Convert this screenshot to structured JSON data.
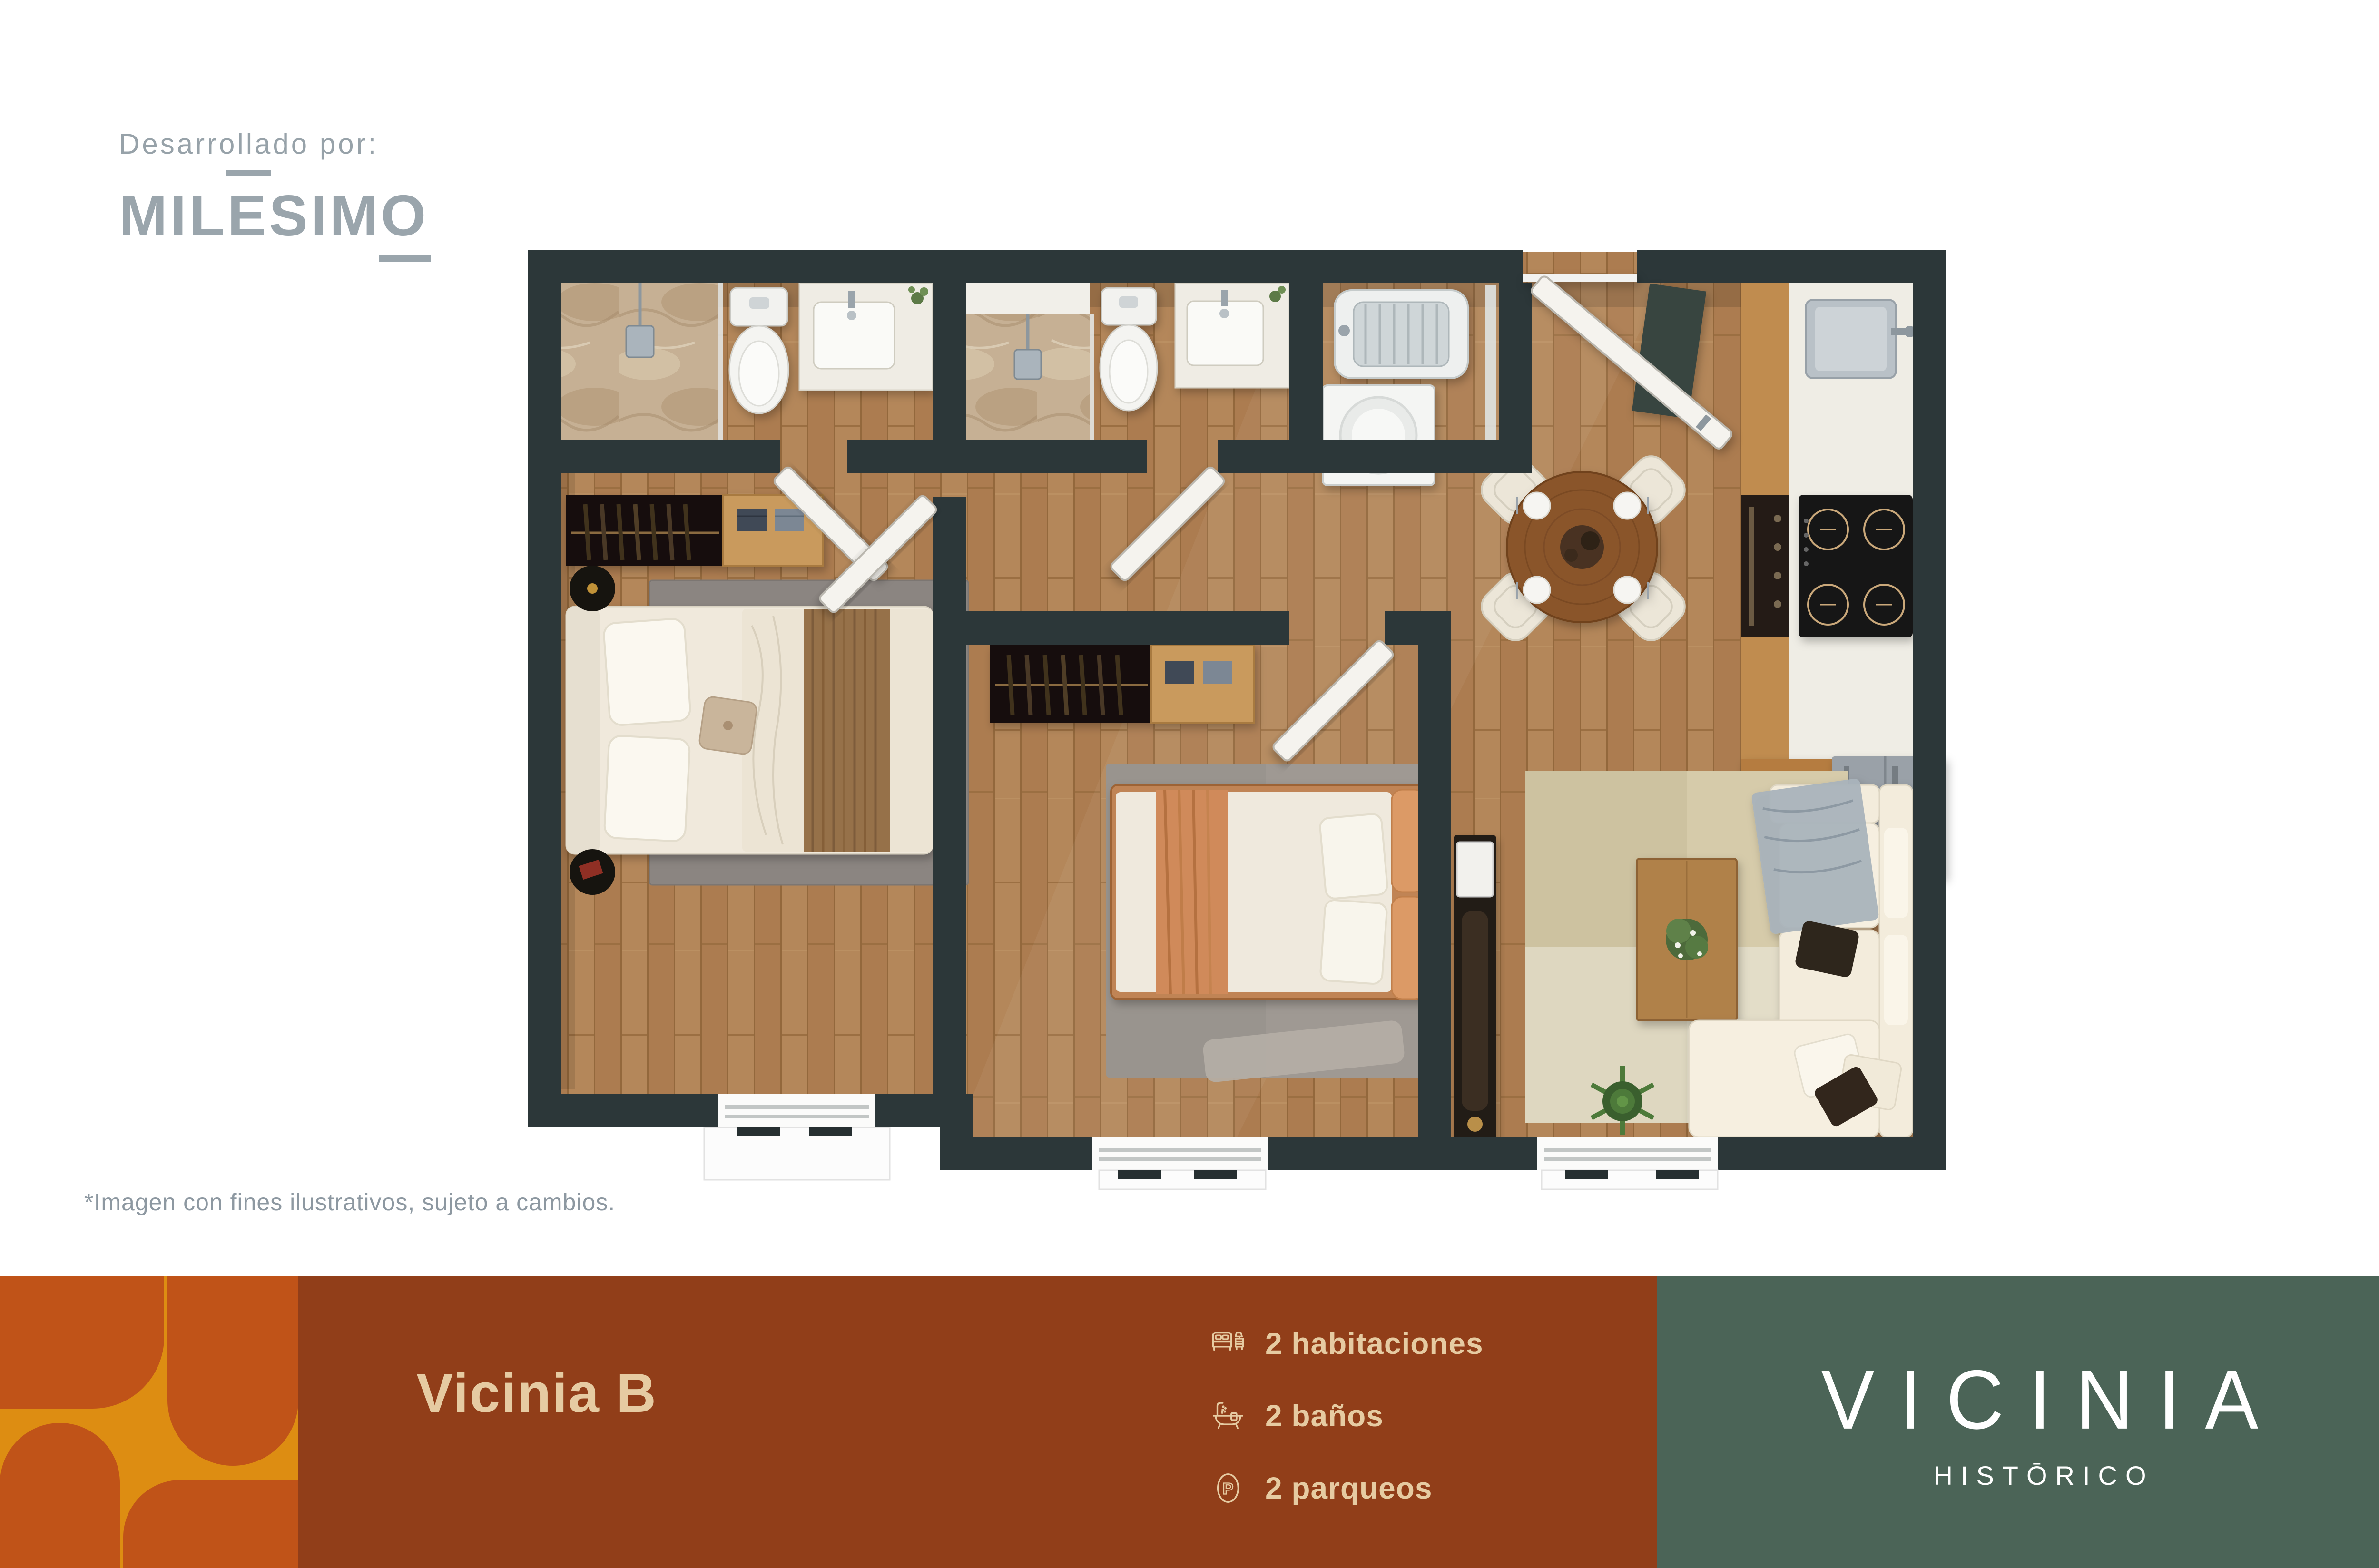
{
  "branding": {
    "developed_by": "Desarrollado por:",
    "developer_logo": {
      "p1": "MIL",
      "p2": "E",
      "p3": "SIM",
      "p4": "O"
    }
  },
  "disclaimer": "*Imagen con fines ilustrativos, sujeto a cambios.",
  "banner": {
    "title": "Vicinia B",
    "features": [
      {
        "icon": "bed-icon",
        "label": "2 habitaciones"
      },
      {
        "icon": "bathtub-icon",
        "label": "2 baños"
      },
      {
        "icon": "parking-icon",
        "label": "2 parqueos"
      }
    ],
    "parking_letter": "P",
    "brand": {
      "name": "VICINIA",
      "subtitle": "HISTŌRICO"
    }
  },
  "floor_plan": {
    "rooms": [
      "bathroom-1",
      "bathroom-2",
      "laundry",
      "kitchen",
      "dining",
      "bedroom-1",
      "bedroom-2",
      "living-room",
      "entry"
    ],
    "colors": {
      "wall": "#2c3739",
      "wood_floor": "#b4875a",
      "marble": "#c6b094",
      "white_fixture": "#f2f2ef",
      "amber": "#dd8d12",
      "orange_shape": "#c05318",
      "terracotta": "#913e19",
      "green": "#4b6457",
      "cream": "#e6cba2",
      "logo_gray": "#9aa5ac"
    }
  }
}
